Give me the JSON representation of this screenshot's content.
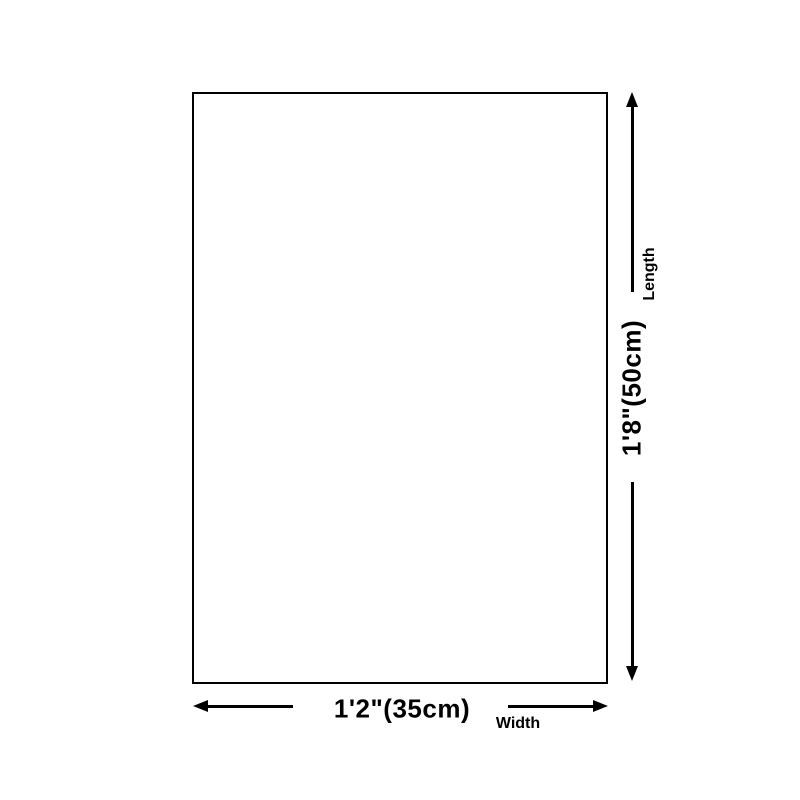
{
  "page": {
    "background_color": "#ffffff",
    "line_color": "#000000"
  },
  "diagram": {
    "type": "product-dimension-diagram",
    "outline": {
      "shape": "rectangle",
      "fill": "#ffffff",
      "border_color": "#000000"
    },
    "dimensions": {
      "length": {
        "value": "1'8\"(50cm)",
        "label": "Length",
        "orientation": "vertical"
      },
      "width": {
        "value": "1'2\"(35cm)",
        "label": "Width",
        "orientation": "horizontal"
      }
    }
  }
}
